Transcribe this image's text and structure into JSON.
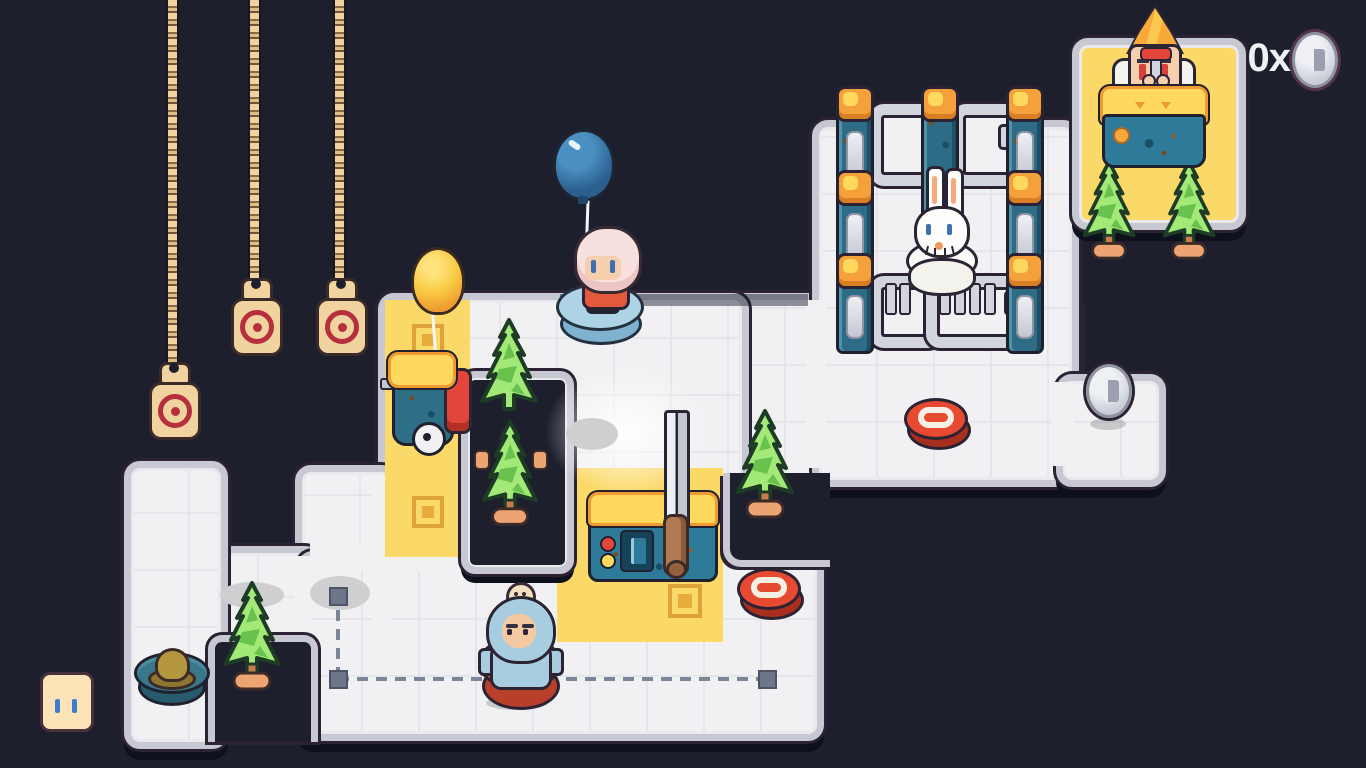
{
  "hud": {
    "coin_count_label": "0x",
    "coin_icon": "coin-icon"
  },
  "colors": {
    "background": "#1d1f2d",
    "floor": "#f1f1f3",
    "floor_border": "#c7c8d2",
    "outline_dark": "#2b2233",
    "highlight_tile_yellow": "#fbd968",
    "marker_orange": "#dfa23a",
    "pillar_blue": "#2e6b86",
    "lamp_orange": "#f5a13b",
    "lamp_core_yellow": "#ffd95e",
    "gate_silver": "#d3d5de",
    "tree_green_light": "#a3e977",
    "tree_green_dark": "#69c24d",
    "pot_orange": "#eca472",
    "button_red": "#e64a30",
    "button_ring_white": "#f6f0e4",
    "pouf_blue": "#aed3e6",
    "pouf_red": "#d94f35",
    "platform_teal": "#39778b",
    "balloon_blue": "#2b5f8e",
    "balloon_yellow": "#f8c940",
    "chain_tan": "#f1d3a0",
    "target_red": "#b5303c",
    "machine_blue": "#2e7a99",
    "machine_top_yellow": "#ffd95e",
    "machine_rim_orange": "#ef9b31",
    "sword_blade_silver": "#eef0f4",
    "sword_handle_brown": "#b07a52",
    "skin": "#f6cfae",
    "hair_pink": "#f7e0dd",
    "shirt_red": "#e2593c",
    "suit_blue": "#a8cde0",
    "coin_silver": "#d9dce3",
    "hud_text": "#eef0f6",
    "path_gray": "#7c8498",
    "face_blob_cream": "#fce4b8"
  },
  "entities": [
    "hanging-chain-target x3",
    "blue-balloon",
    "yellow-balloon",
    "pink-hair-character on blue pouf",
    "rabbit on white base",
    "blue-suit-character on red pouf",
    "desk-operator with plunger",
    "fire-extinguisher-cart",
    "sword-machine",
    "control-desk",
    "red-pad x2",
    "floor-coin",
    "pine-tree x6",
    "pillar x3 with lamps",
    "gate x4",
    "hat on teal platform",
    "cream-face-blob",
    "yellow-highlight-zones with markers",
    "dashed-route with waypoints"
  ]
}
